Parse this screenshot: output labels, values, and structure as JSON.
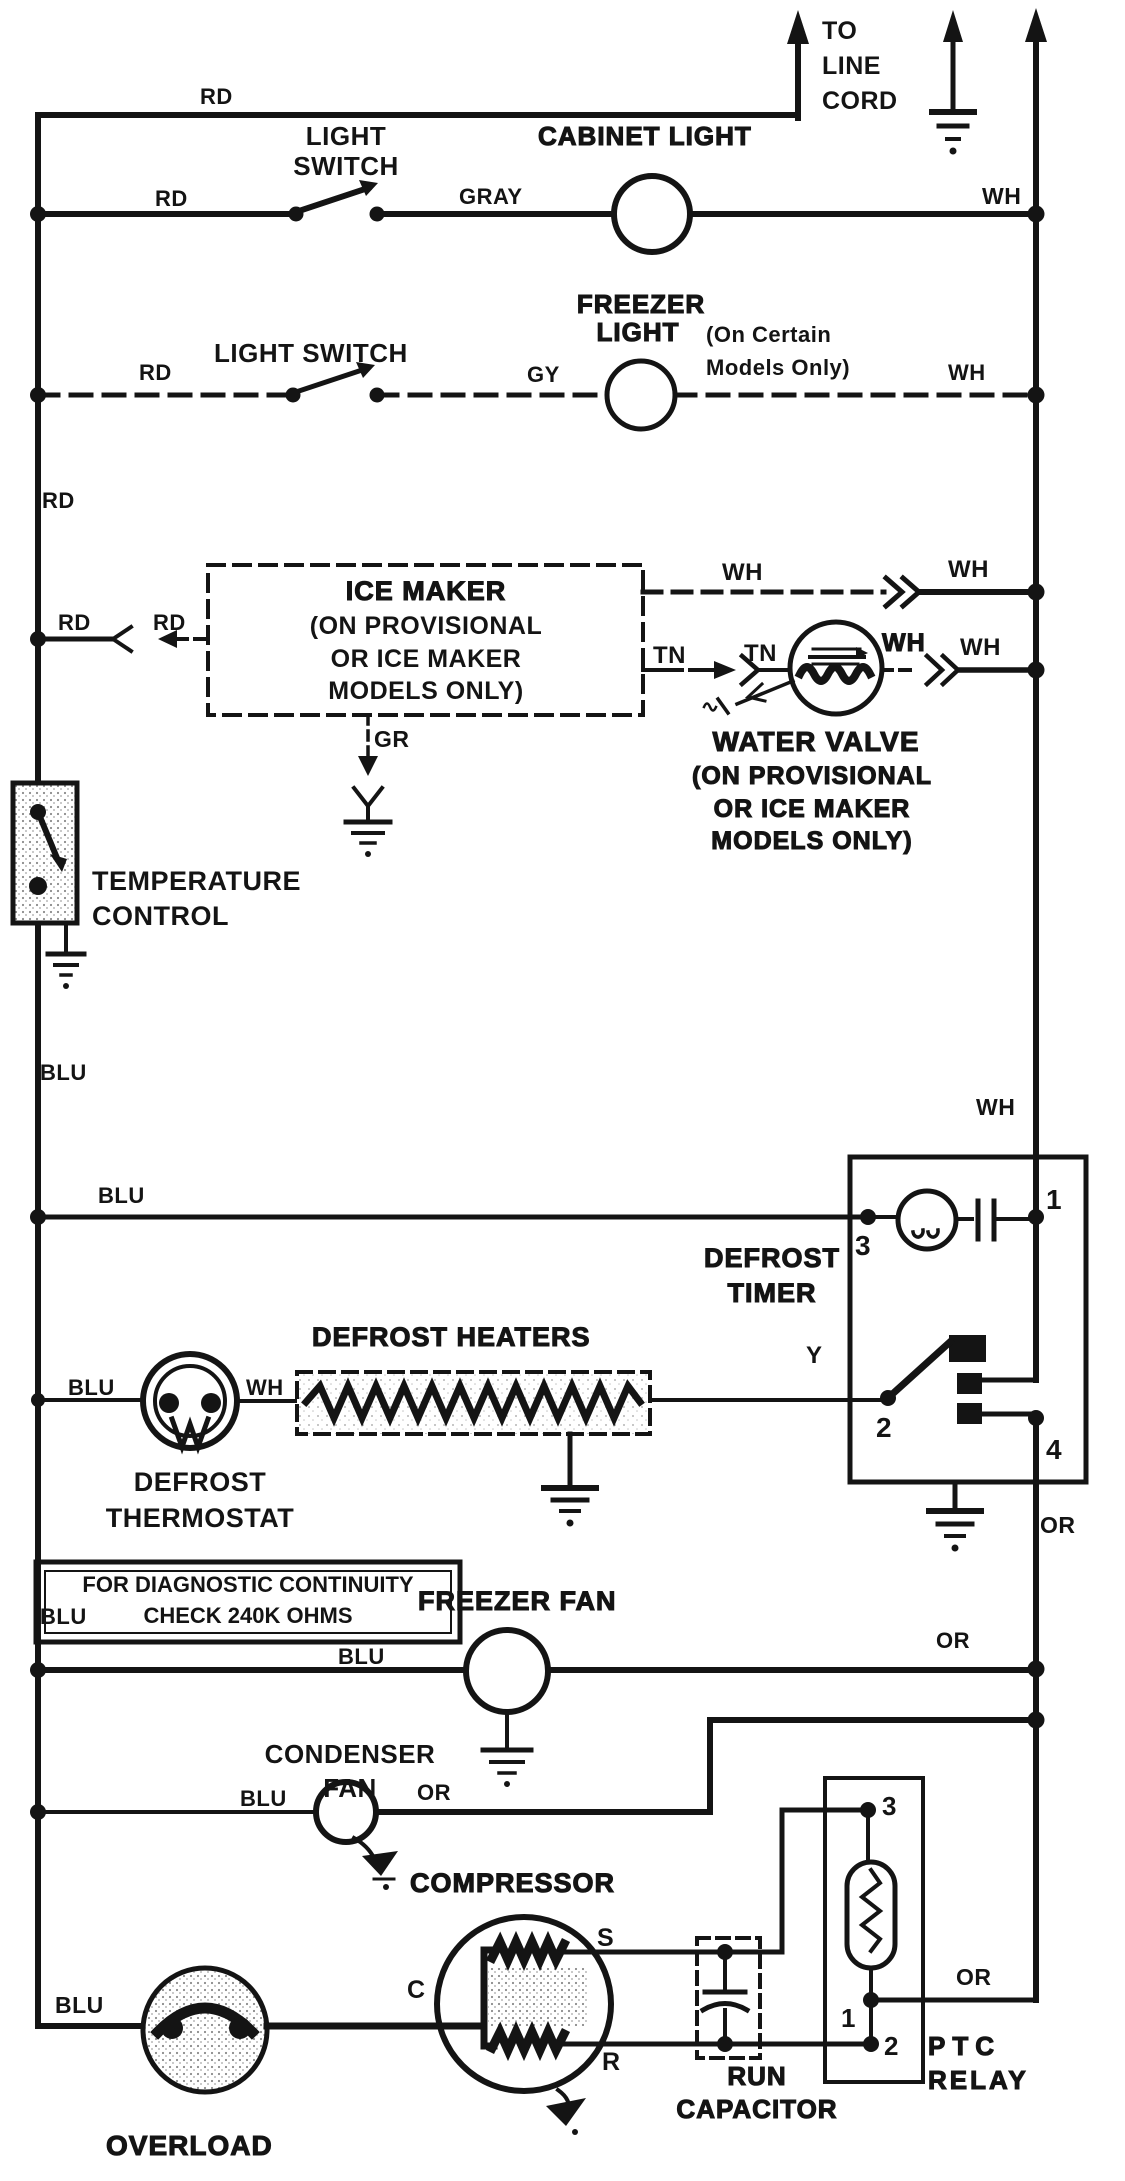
{
  "meta": {
    "background": "#ffffff",
    "ink": "#141414"
  },
  "header": {
    "to_line_cord": "TO\nLINE\nCORD",
    "rd": "RD"
  },
  "cabinet_row": {
    "title": "CABINET LIGHT",
    "switch": "LIGHT\nSWITCH",
    "rd": "RD",
    "gray": "GRAY",
    "wh": "WH"
  },
  "freezer_row": {
    "title_1": "FREEZER",
    "title_2": "LIGHT",
    "note": "(On Certain\nModels Only)",
    "switch": "LIGHT SWITCH",
    "rd": "RD",
    "gy": "GY",
    "wh": "WH"
  },
  "left_rail": {
    "rd": "RD",
    "blu_upper": "BLU",
    "blu_lower": "BLU"
  },
  "ice_maker": {
    "title": "ICE MAKER",
    "subtitle": "(ON PROVISIONAL\nOR ICE MAKER\nMODELS ONLY)",
    "rd_outer": "RD",
    "rd_inner": "RD",
    "gr": "GR",
    "wh_row_left": "WH",
    "wh_row_right": "WH",
    "tn_left": "TN",
    "tn_right": "TN"
  },
  "water_valve": {
    "title": "WATER VALVE",
    "subtitle": "(ON PROVISIONAL\nOR ICE MAKER\nMODELS ONLY)",
    "wh_left": "WH",
    "wh_right": "WH"
  },
  "temperature_control": {
    "label": "TEMPERATURE\nCONTROL"
  },
  "defrost_timer": {
    "title": "DEFROST\nTIMER",
    "wh": "WH",
    "or": "OR",
    "t1": "1",
    "t2": "2",
    "t3": "3",
    "t4": "4",
    "blu": "BLU"
  },
  "defrost_heaters": {
    "title": "DEFROST HEATERS",
    "y": "Y"
  },
  "defrost_thermostat": {
    "title": "DEFROST\nTHERMOSTAT",
    "blu": "BLU",
    "wh": "WH"
  },
  "diagnostic_note": {
    "text": "FOR DIAGNOSTIC CONTINUITY\nCHECK 240K OHMS"
  },
  "freezer_fan": {
    "title": "FREEZER FAN",
    "blu": "BLU",
    "or": "OR"
  },
  "condenser_fan": {
    "title": "CONDENSER\nFAN",
    "blu": "BLU",
    "or": "OR"
  },
  "compressor": {
    "title": "COMPRESSOR",
    "s": "S",
    "c": "C",
    "r": "R",
    "blu": "BLU"
  },
  "overload": {
    "label": "OVERLOAD"
  },
  "run_capacitor": {
    "label": "RUN\nCAPACITOR"
  },
  "ptc_relay": {
    "title_1": "PTC",
    "title_2": "RELAY",
    "t1": "1",
    "t2": "2",
    "t3": "3",
    "or": "OR"
  }
}
